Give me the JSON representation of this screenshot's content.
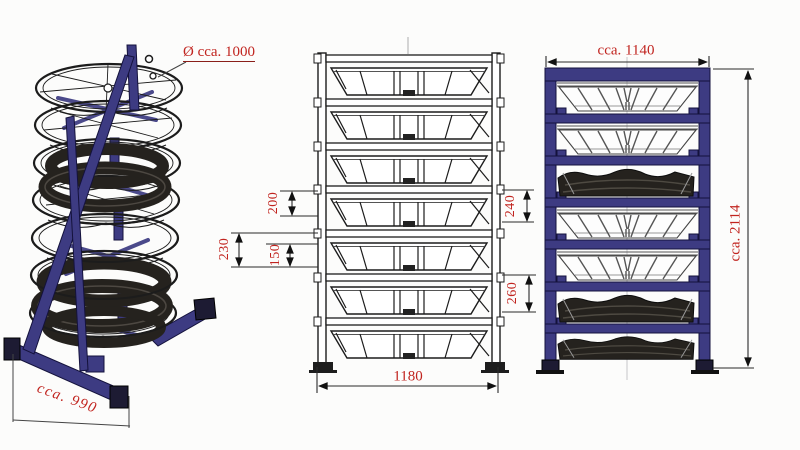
{
  "document": {
    "type": "technical drawing",
    "subject": "stackable rack with tires - isometric, front and side views"
  },
  "colors": {
    "dimension_red": "#c1241f",
    "frame_blue": "#3d3b82",
    "ink_black": "#1c1c1c",
    "tire_dark": "#25221e",
    "strut_gray": "#555555",
    "background": "#fcfcfb"
  },
  "views": {
    "isometric": {
      "label": "isometric view",
      "diameter_label": "Ø cca. 1000",
      "base_width_label": "cca. 990"
    },
    "front": {
      "label": "front view",
      "dims": {
        "gap_top": "200",
        "pitch": "230",
        "gap_bottom": "150",
        "right_top": "240",
        "right_bottom": "260",
        "overall_width": "1180"
      }
    },
    "side": {
      "label": "side view",
      "overall_width": "cca. 1140",
      "overall_height": "cca. 2114"
    }
  }
}
